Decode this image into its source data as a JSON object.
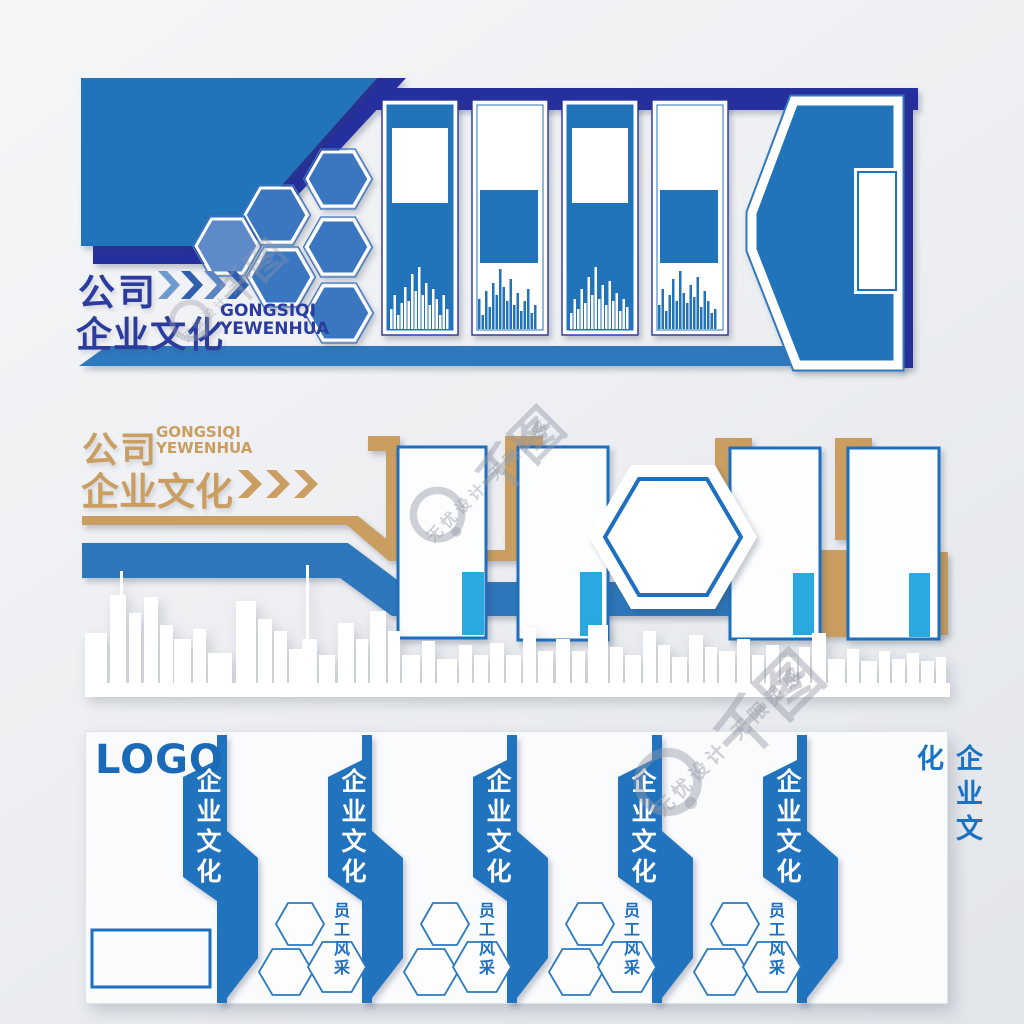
{
  "top_wall": {
    "title_cn": "公司",
    "subtitle_cn": "企业文化",
    "pinyin_line1": "GONGSIQI",
    "pinyin_line2": "YEWENHUA"
  },
  "mid_wall": {
    "title_cn": "公司",
    "subtitle_cn": "企业文化",
    "pinyin_line1": "GONGSIQI",
    "pinyin_line2": "YEWENHUA"
  },
  "bottom_wall": {
    "logo": "LOGO",
    "ribbons": [
      "企业文化",
      "企业文化",
      "企业文化",
      "企业文化",
      "企业文化"
    ],
    "staff_groups": [
      {
        "line1": "员 工",
        "line2": "风 采"
      },
      {
        "line1": "员 工",
        "line2": "风 采"
      },
      {
        "line1": "员 工",
        "line2": "风 采"
      },
      {
        "line1": "员 工",
        "line2": "风 采"
      }
    ],
    "right_label": "企业文化"
  },
  "watermark": {
    "brand_mark": "千图",
    "slogan": "无忧设计 无限灵感"
  },
  "colors": {
    "navy": "#262f9e",
    "main_blue": "#2173ba",
    "steel_blue": "#2e79bd",
    "accent_light_blue": "#2aa9e0",
    "tan": "#c99e60",
    "panel_border_blue": "#1d6fbf",
    "ribbon_blue": "#2173bd",
    "title_navy": "#2b3c9e",
    "logo_blue": "#1a6ab8"
  },
  "decor": {
    "bar_panels": [
      {
        "x": 390,
        "base": 329,
        "color": "#ffffff",
        "heights": [
          20,
          34,
          14,
          26,
          42,
          28,
          55,
          38,
          62,
          34,
          46,
          24,
          40,
          30,
          14,
          34,
          20
        ]
      },
      {
        "x": 478,
        "base": 329,
        "color": "#2173ba",
        "heights": [
          30,
          14,
          38,
          22,
          46,
          34,
          60,
          42,
          28,
          50,
          24,
          36,
          18,
          28,
          40,
          16,
          24
        ]
      },
      {
        "x": 570,
        "base": 329,
        "color": "#ffffff",
        "heights": [
          16,
          30,
          20,
          40,
          26,
          52,
          34,
          62,
          30,
          44,
          24,
          48,
          28,
          36,
          18,
          30,
          22
        ]
      },
      {
        "x": 658,
        "base": 329,
        "color": "#2173ba",
        "heights": [
          24,
          40,
          18,
          34,
          50,
          28,
          58,
          36,
          26,
          44,
          32,
          52,
          22,
          38,
          28,
          16,
          20
        ]
      }
    ],
    "cluster_hexagons": [
      [
        338,
        179,
        0
      ],
      [
        276,
        215,
        0
      ],
      [
        227,
        246,
        1
      ],
      [
        338,
        247,
        0
      ],
      [
        281,
        277,
        0
      ],
      [
        339,
        313,
        0
      ]
    ],
    "trio_group_x": [
      328,
      473,
      618,
      763
    ],
    "trio_offsets": [
      [
        -28,
        924,
        24,
        21
      ],
      [
        -42,
        972,
        27,
        23
      ],
      [
        9,
        967,
        29,
        25
      ]
    ],
    "skyline_buildings": [
      [
        85,
        22,
        50
      ],
      [
        110,
        16,
        88
      ],
      [
        129,
        12,
        70
      ],
      [
        144,
        14,
        86
      ],
      [
        160,
        13,
        58
      ],
      [
        174,
        17,
        44
      ],
      [
        193,
        13,
        54
      ],
      [
        208,
        24,
        30
      ],
      [
        236,
        20,
        82
      ],
      [
        258,
        14,
        64
      ],
      [
        274,
        13,
        52
      ],
      [
        289,
        13,
        34
      ],
      [
        303,
        14,
        44
      ],
      [
        319,
        16,
        28
      ],
      [
        338,
        16,
        60
      ],
      [
        356,
        12,
        44
      ],
      [
        370,
        16,
        72
      ],
      [
        388,
        12,
        52
      ],
      [
        402,
        18,
        28
      ],
      [
        422,
        13,
        42
      ],
      [
        437,
        20,
        24
      ],
      [
        459,
        13,
        38
      ],
      [
        474,
        14,
        28
      ],
      [
        490,
        14,
        40
      ],
      [
        506,
        15,
        28
      ],
      [
        523,
        13,
        55
      ],
      [
        538,
        15,
        32
      ],
      [
        556,
        14,
        44
      ],
      [
        572,
        13,
        32
      ],
      [
        588,
        20,
        58
      ],
      [
        610,
        13,
        36
      ],
      [
        625,
        16,
        28
      ],
      [
        643,
        13,
        52
      ],
      [
        658,
        12,
        38
      ],
      [
        672,
        15,
        26
      ],
      [
        689,
        14,
        48
      ],
      [
        705,
        12,
        36
      ],
      [
        719,
        16,
        32
      ],
      [
        737,
        13,
        44
      ],
      [
        752,
        12,
        28
      ],
      [
        766,
        13,
        38
      ],
      [
        781,
        16,
        26
      ],
      [
        799,
        11,
        36
      ],
      [
        812,
        14,
        50
      ],
      [
        828,
        17,
        24
      ],
      [
        847,
        12,
        34
      ],
      [
        861,
        16,
        22
      ],
      [
        879,
        11,
        32
      ],
      [
        892,
        13,
        24
      ],
      [
        907,
        12,
        30
      ],
      [
        921,
        13,
        22
      ],
      [
        936,
        10,
        26
      ]
    ],
    "skyline_spires": [
      [
        120,
        3,
        112
      ],
      [
        306,
        3,
        118
      ]
    ]
  }
}
